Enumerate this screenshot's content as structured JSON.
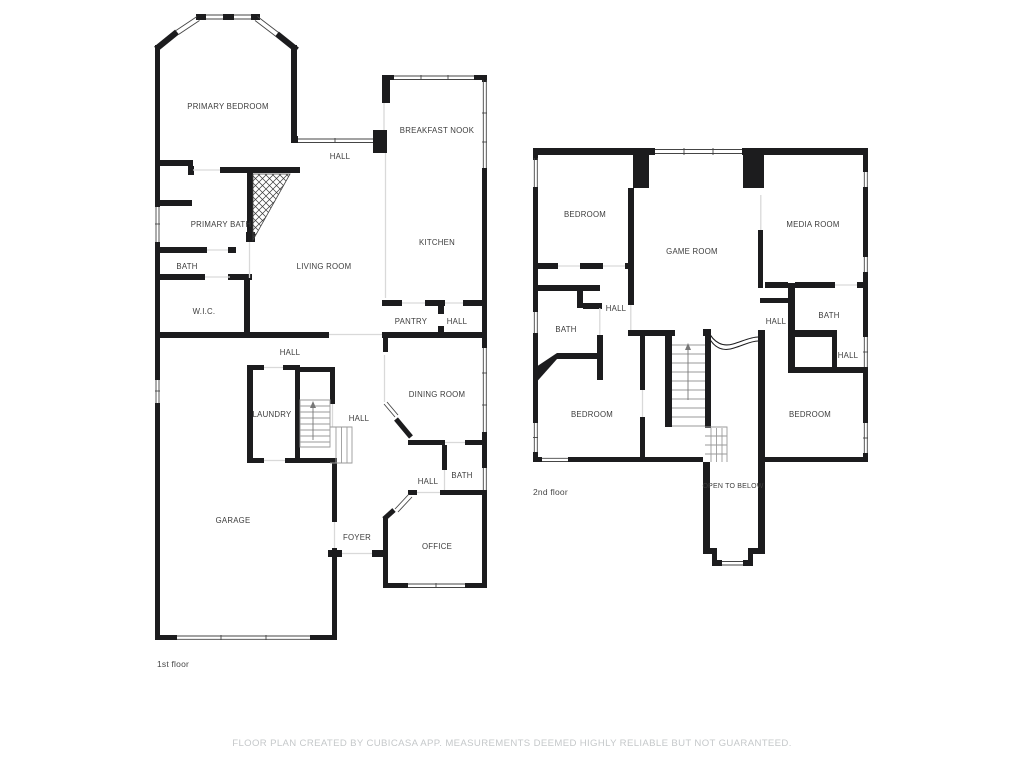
{
  "floor1": {
    "label": "1st floor",
    "rooms": [
      {
        "label": "PRIMARY BEDROOM"
      },
      {
        "label": "HALL"
      },
      {
        "label": "BREAKFAST NOOK"
      },
      {
        "label": "PRIMARY BATH"
      },
      {
        "label": "BATH"
      },
      {
        "label": "LIVING ROOM"
      },
      {
        "label": "KITCHEN"
      },
      {
        "label": "W.I.C."
      },
      {
        "label": "PANTRY"
      },
      {
        "label": "HALL"
      },
      {
        "label": "HALL"
      },
      {
        "label": "LAUNDRY"
      },
      {
        "label": "HALL"
      },
      {
        "label": "DINING ROOM"
      },
      {
        "label": "GARAGE"
      },
      {
        "label": "HALL"
      },
      {
        "label": "BATH"
      },
      {
        "label": "FOYER"
      },
      {
        "label": "OFFICE"
      }
    ]
  },
  "floor2": {
    "label": "2nd floor",
    "rooms": [
      {
        "label": "BEDROOM"
      },
      {
        "label": "GAME ROOM"
      },
      {
        "label": "MEDIA ROOM"
      },
      {
        "label": "HALL"
      },
      {
        "label": "BATH"
      },
      {
        "label": "HALL"
      },
      {
        "label": "BATH"
      },
      {
        "label": "HALL"
      },
      {
        "label": "BEDROOM"
      },
      {
        "label": "BEDROOM"
      },
      {
        "label": "OPEN TO BELOW"
      }
    ]
  },
  "footer": {
    "disclaimer": "FLOOR PLAN CREATED BY CUBICASA APP. MEASUREMENTS DEEMED HIGHLY RELIABLE BUT NOT GUARANTEED."
  },
  "colors": {
    "background": "#ffffff",
    "wall": "#1c1c1e",
    "window_line": "#454545",
    "open_line": "#d9d9d9",
    "stair_line": "#9a9a9a",
    "room_label": "#3c3c3c",
    "floor_label": "#474747",
    "footer_text": "#c5c8ca"
  }
}
